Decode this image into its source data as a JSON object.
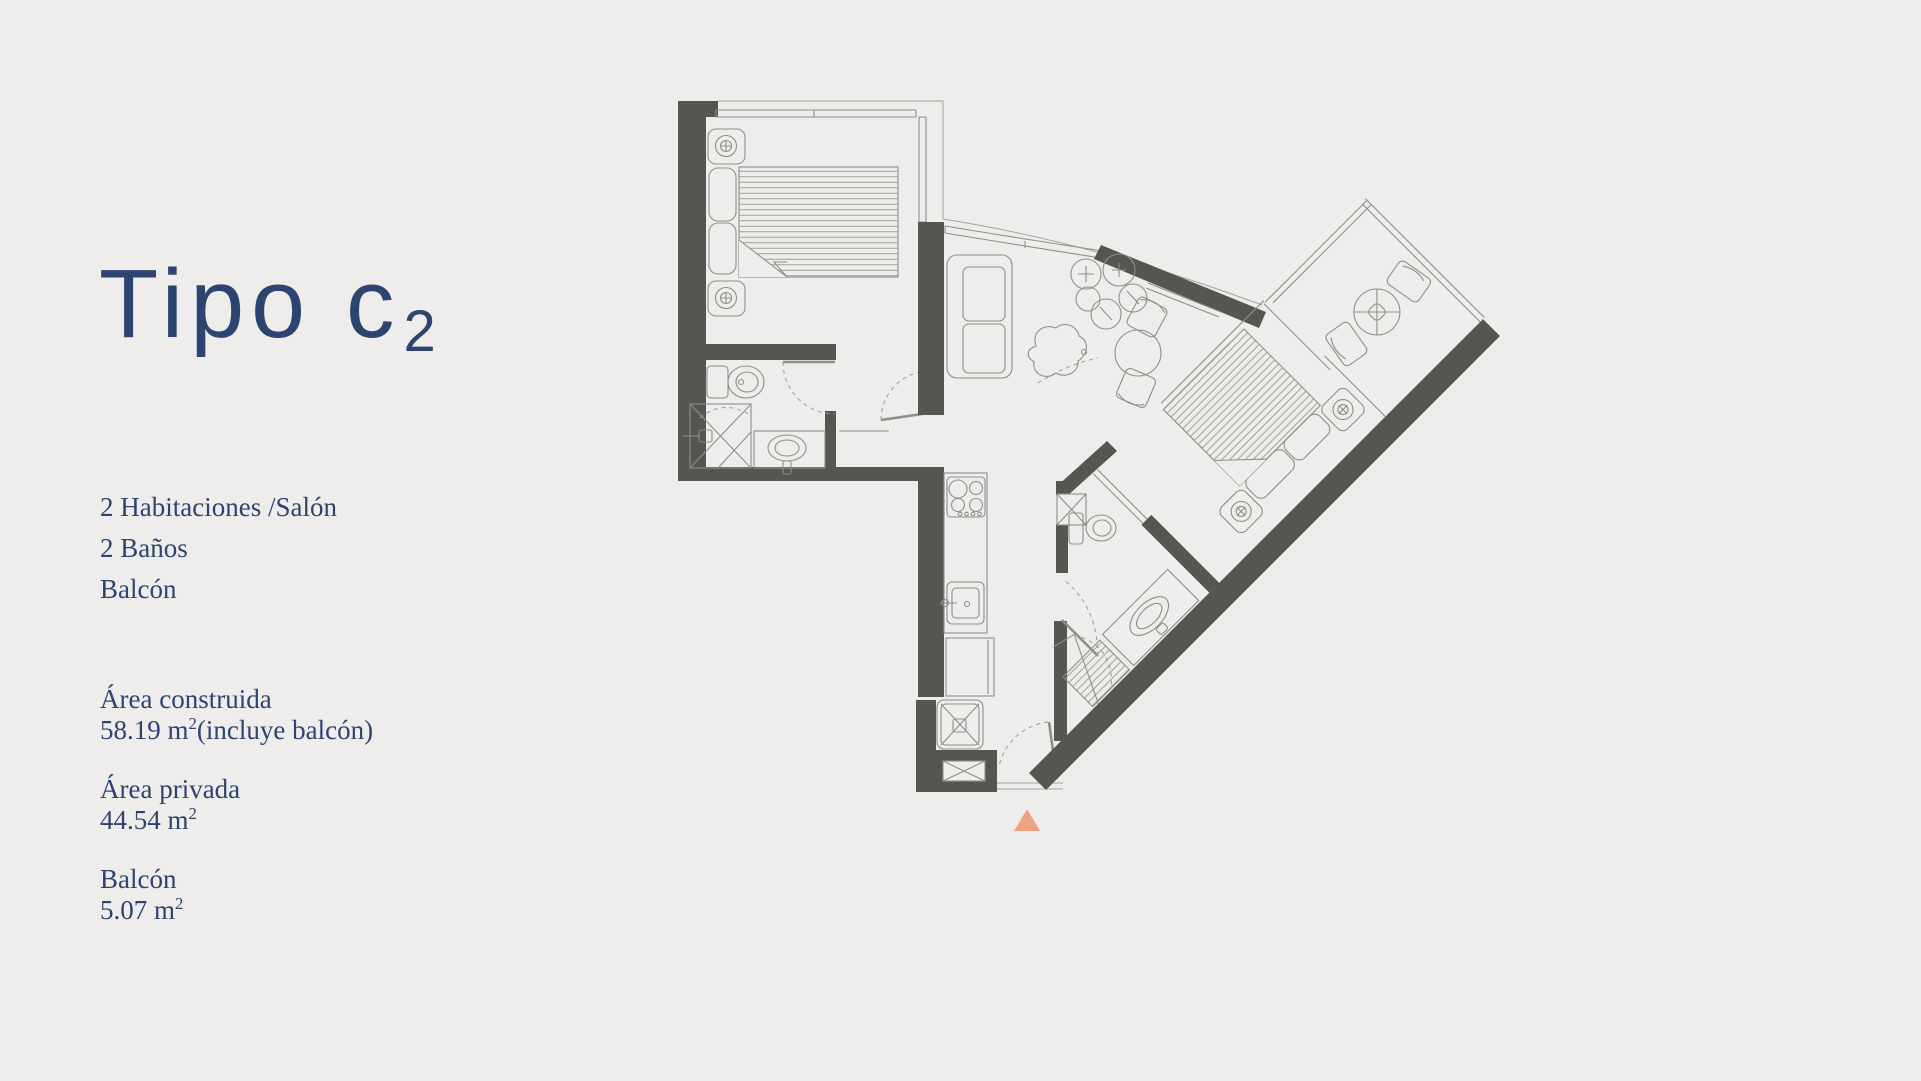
{
  "page": {
    "background": "#efedeb"
  },
  "panel": {
    "text_color": "#2d4470",
    "title": {
      "main": "Tipo c",
      "subscript": "2"
    },
    "features": [
      "2 Habitaciones /Salón",
      "2 Baños",
      "Balcón"
    ],
    "areas": [
      {
        "label": "Área construida",
        "value": "58.19 m",
        "sup": "2",
        "suffix": "(incluye balcón)"
      },
      {
        "label": "Área privada",
        "value": "44.54 m",
        "sup": "2",
        "suffix": ""
      },
      {
        "label": "Balcón",
        "value": "5.07 m",
        "sup": "2",
        "suffix": ""
      }
    ]
  },
  "floor_plan": {
    "wall_color": "#565551",
    "line_color": "#8f8e8a",
    "entrance_marker_color": "#efa183"
  }
}
